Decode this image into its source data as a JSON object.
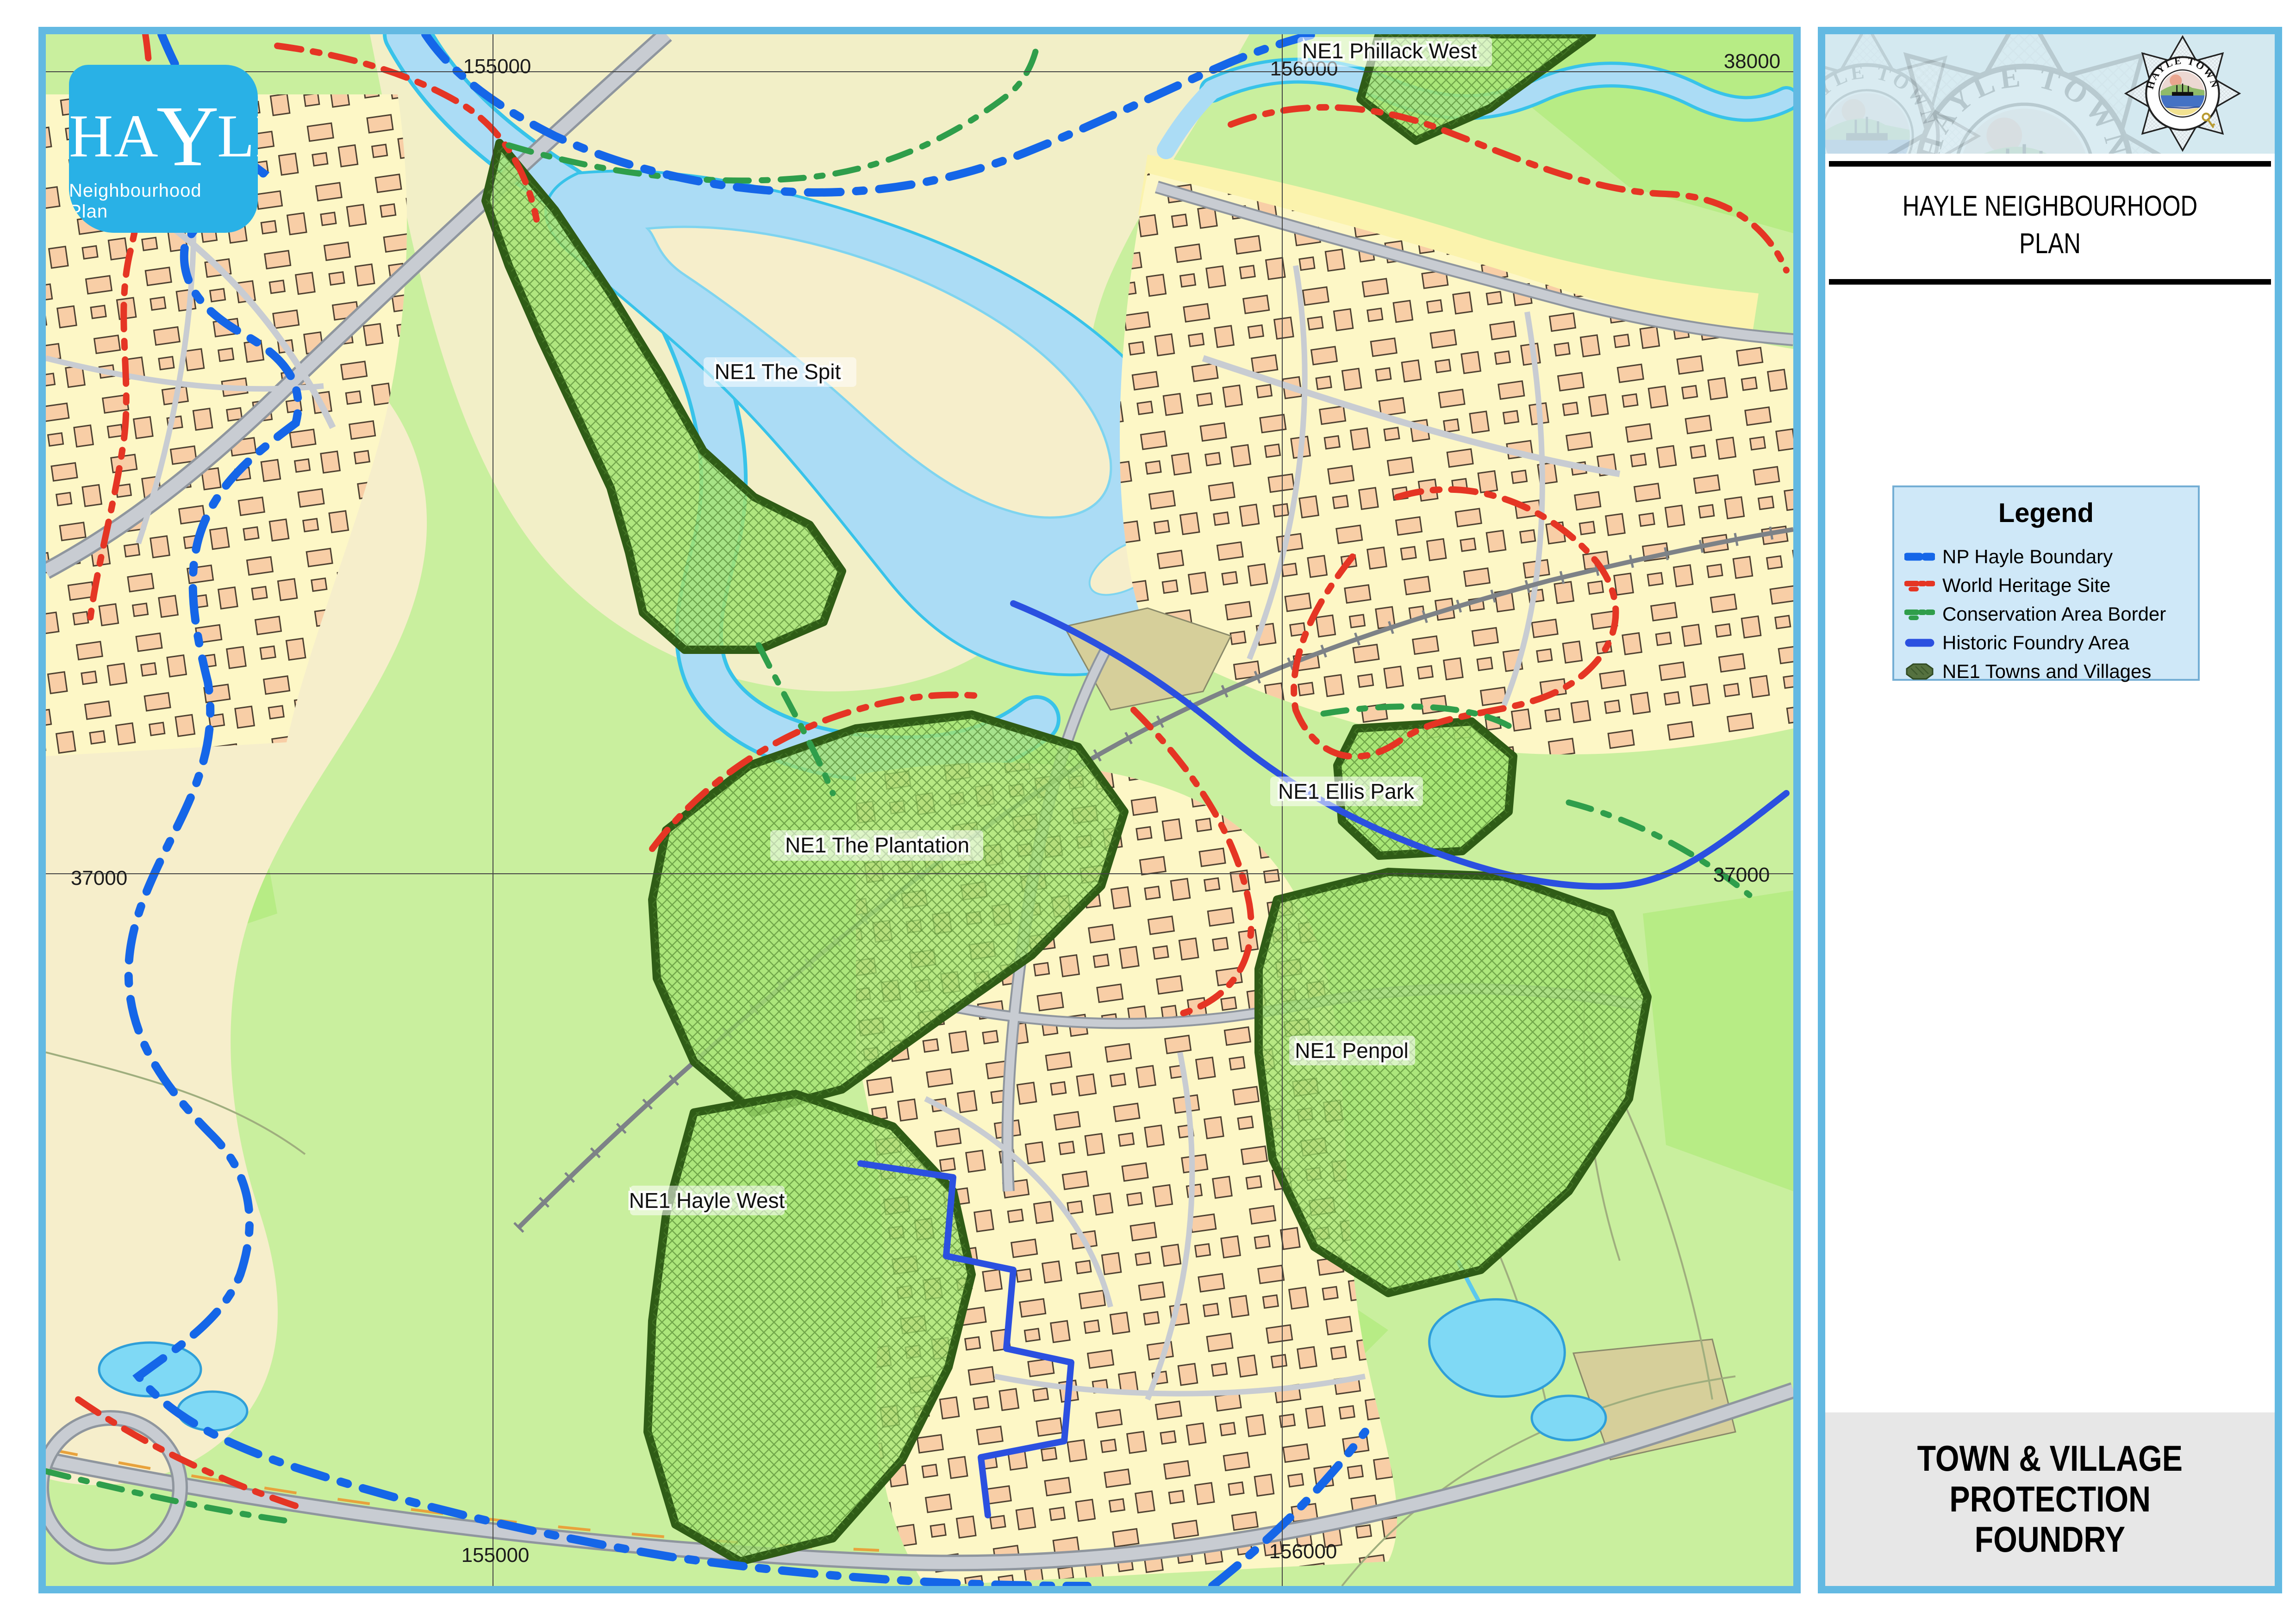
{
  "frame": {
    "border_color": "#63b9e2"
  },
  "logo": {
    "name_part1": "HA",
    "name_y": "Y",
    "name_part2": "LE",
    "subtitle": "Neighbourhood Plan",
    "bg": "#29b1e6"
  },
  "panel": {
    "crest_text": "HAYLE TOWN COUNCIL",
    "title_line1": "HAYLE NEIGHBOURHOOD",
    "title_line2": "PLAN",
    "legend": {
      "title": "Legend",
      "items": [
        {
          "label": "NP Hayle Boundary",
          "color": "#1566e8",
          "style": "thick-blue-dash"
        },
        {
          "label": "World Heritage Site",
          "color": "#e53524",
          "style": "red-dash-dot"
        },
        {
          "label": "Conservation Area Border",
          "color": "#2f9e4b",
          "style": "green-dash-dot"
        },
        {
          "label": "Historic Foundry Area",
          "color": "#2b50e0",
          "style": "solid-blue"
        },
        {
          "label": "NE1 Towns and Villages",
          "color": "#55713f",
          "style": "hatched-polygon"
        }
      ]
    },
    "footer_line1": "TOWN & VILLAGE",
    "footer_line2": "PROTECTION",
    "footer_line3": "FOUNDRY"
  },
  "map": {
    "labels": {
      "phillack": "NE1 Phillack West",
      "spit": "NE1 The Spit",
      "plantation": "NE1 The Plantation",
      "ellis": "NE1 Ellis Park",
      "penpol": "NE1 Penpol",
      "hayle_west": "NE1 Hayle West"
    },
    "grid": {
      "top_155000": "155000",
      "top_156000": "156000",
      "top_38000": "38000",
      "left_37000": "37000",
      "right_37000": "37000",
      "bottom_155000": "155000",
      "bottom_156000": "156000"
    },
    "colors": {
      "field_green": "#c9ef9e",
      "bright_green": "#b7ec85",
      "urban_yellow": "#fdf7c6",
      "sand": "#f6eecb",
      "beach_yellow": "#fbf3ad",
      "water": "#abdcf5",
      "water_edge": "#38c3e9",
      "np_boundary": "#1566e8",
      "world_heritage": "#e53524",
      "conservation": "#2f9e4b",
      "foundry": "#2b50e0",
      "ne1_fill": "#a5e472",
      "ne1_border": "#2f5c16",
      "road_fill": "#c8ccd2",
      "building": "#f7c9a2"
    }
  }
}
